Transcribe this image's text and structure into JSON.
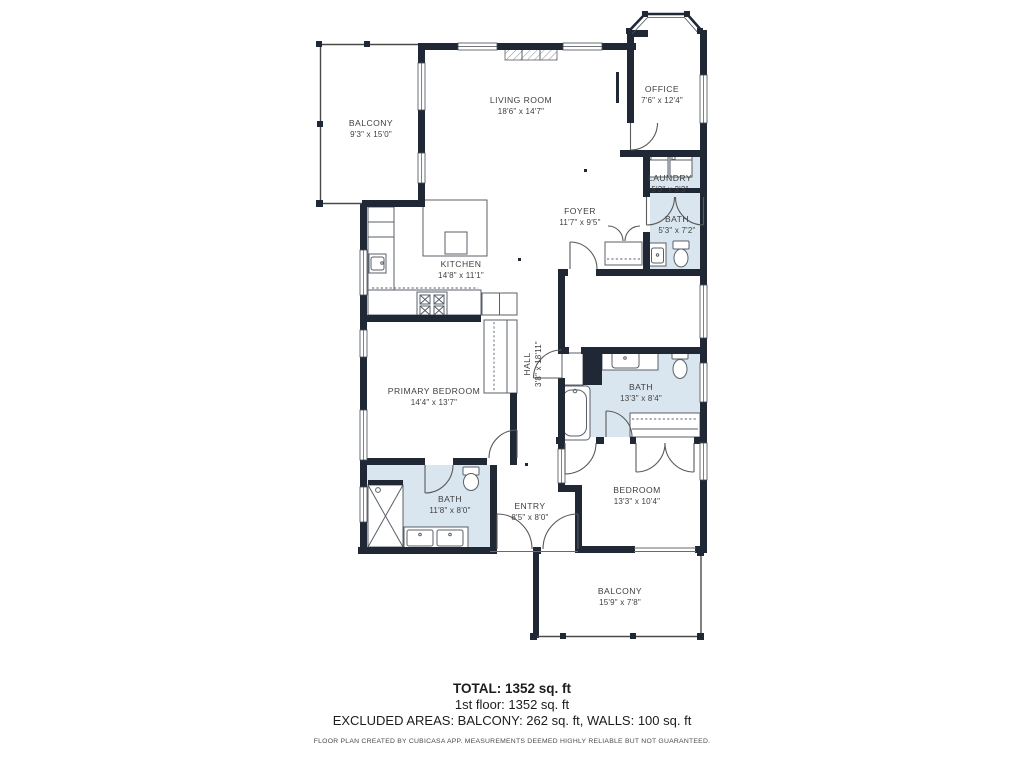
{
  "floor_plan": {
    "rooms": [
      {
        "id": "balcony-top",
        "name": "BALCONY",
        "dims": "9'3\" x 15'0\"",
        "cx": 371,
        "cy": 123
      },
      {
        "id": "living-room",
        "name": "LIVING ROOM",
        "dims": "18'6\" x 14'7\"",
        "cx": 521,
        "cy": 100
      },
      {
        "id": "office",
        "name": "OFFICE",
        "dims": "7'6\" x 12'4\"",
        "cx": 662,
        "cy": 89
      },
      {
        "id": "laundry",
        "name": "LAUNDRY",
        "dims": "5'3\" x 3'3\"",
        "cx": 670,
        "cy": 178
      },
      {
        "id": "foyer",
        "name": "FOYER",
        "dims": "11'7\" x 9'5\"",
        "cx": 580,
        "cy": 211
      },
      {
        "id": "bath-upper",
        "name": "BATH",
        "dims": "5'3\" x 7'2\"",
        "cx": 677,
        "cy": 219
      },
      {
        "id": "kitchen",
        "name": "KITCHEN",
        "dims": "14'8\" x 11'1\"",
        "cx": 461,
        "cy": 264
      },
      {
        "id": "primary-bedroom",
        "name": "PRIMARY BEDROOM",
        "dims": "14'4\" x 13'7\"",
        "cx": 434,
        "cy": 391
      },
      {
        "id": "hall",
        "name": "HALL",
        "dims": "3'8\" x 18'11\"",
        "cx": 527,
        "cy": 364,
        "rotate": -90
      },
      {
        "id": "bath-main",
        "name": "BATH",
        "dims": "13'3\" x 8'4\"",
        "cx": 641,
        "cy": 387
      },
      {
        "id": "bedroom",
        "name": "BEDROOM",
        "dims": "13'3\" x 10'4\"",
        "cx": 637,
        "cy": 490
      },
      {
        "id": "bath-lower",
        "name": "BATH",
        "dims": "11'8\" x 8'0\"",
        "cx": 450,
        "cy": 499
      },
      {
        "id": "entry",
        "name": "ENTRY",
        "dims": "8'5\" x 8'0\"",
        "cx": 530,
        "cy": 506
      },
      {
        "id": "balcony-bottom",
        "name": "BALCONY",
        "dims": "15'9\" x 7'8\"",
        "cx": 620,
        "cy": 591
      }
    ]
  },
  "summary": {
    "total": "TOTAL: 1352 sq. ft",
    "floor1": "1st floor: 1352 sq. ft",
    "excluded": "EXCLUDED AREAS: BALCONY: 262 sq. ft, WALLS: 100 sq. ft",
    "disclaimer": "FLOOR PLAN CREATED BY CUBICASA APP. MEASUREMENTS DEEMED HIGHLY RELIABLE BUT NOT GUARANTEED."
  },
  "colors": {
    "wall": "#1f2834",
    "wet_room_fill": "#d9e6ef",
    "thin_line": "#555555",
    "label_text": "#3f3f3f"
  }
}
